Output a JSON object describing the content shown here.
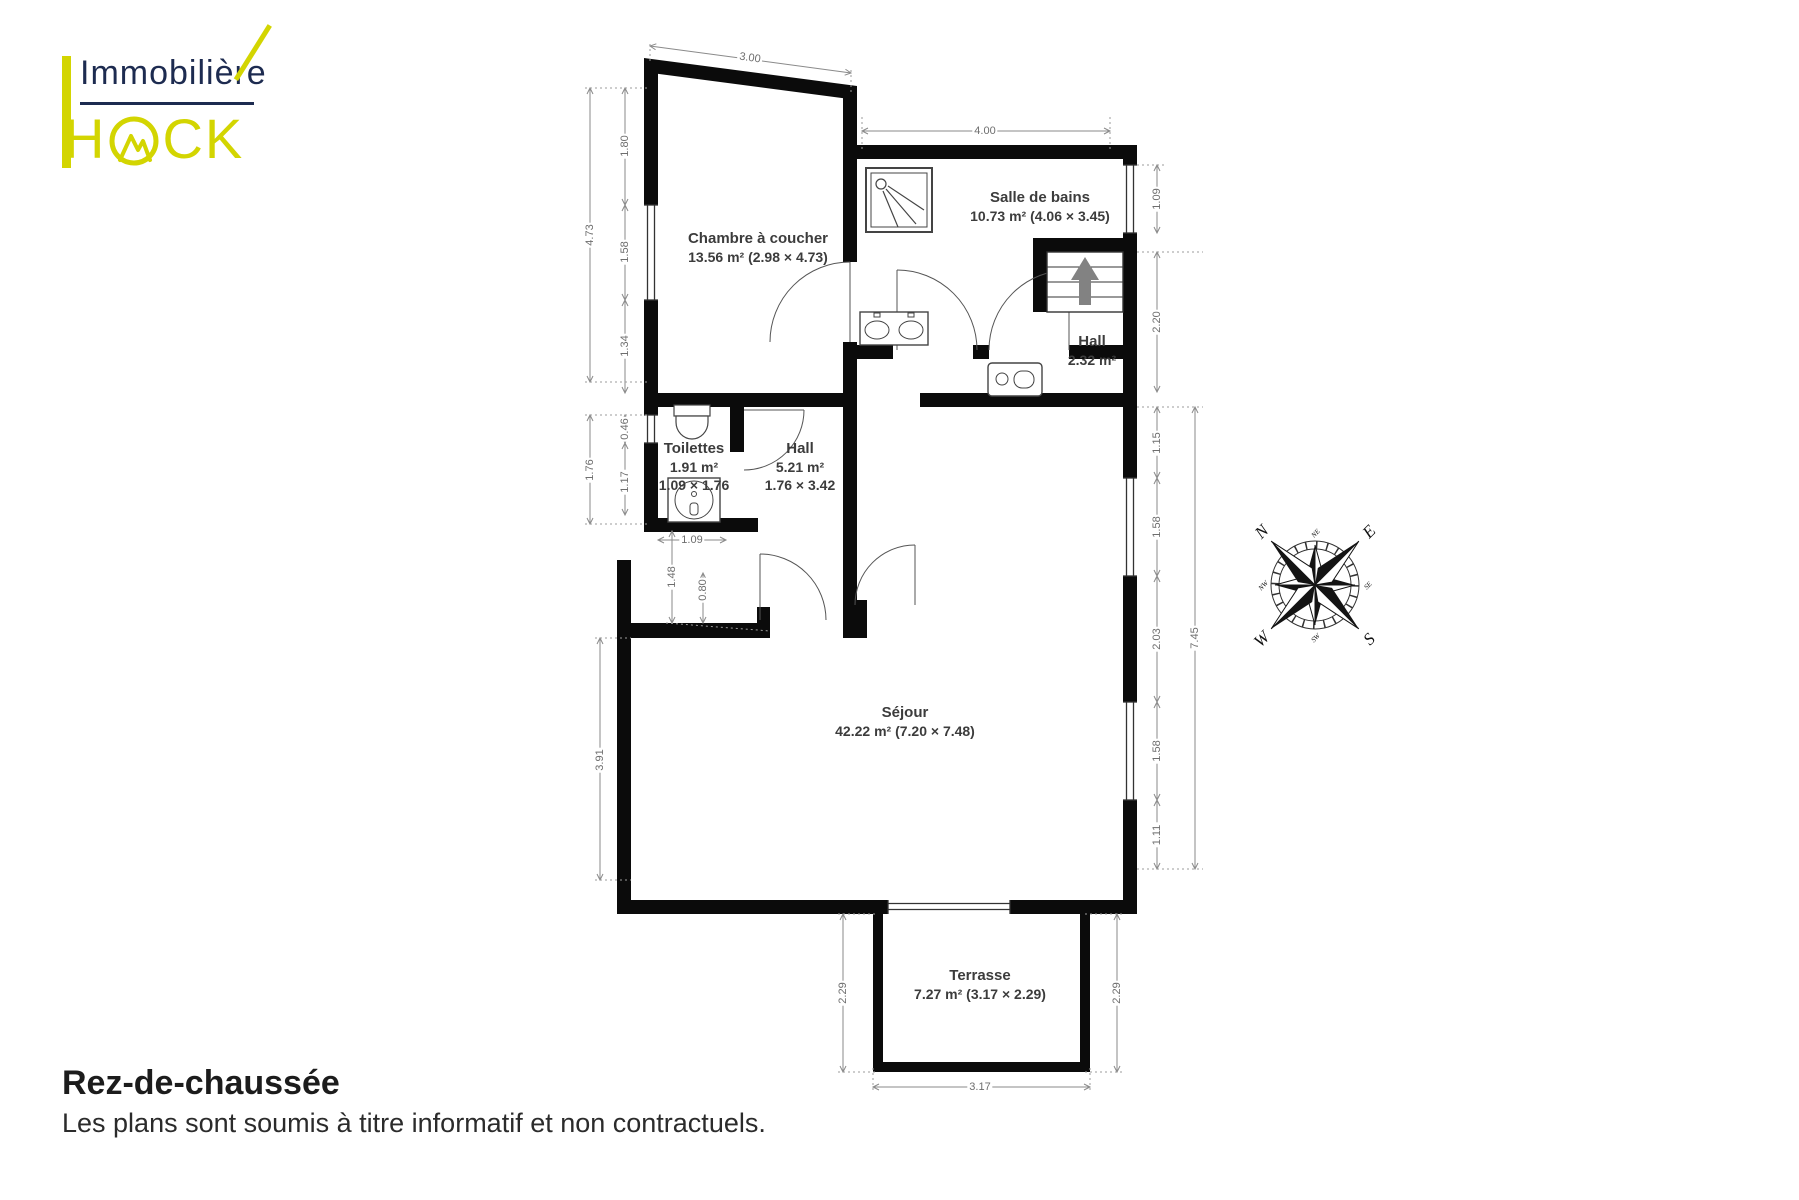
{
  "logo": {
    "name1": "Immobilière",
    "name2_full": "HACK",
    "name2_h": "H",
    "name2_ck": "CK"
  },
  "rooms": {
    "chambre": {
      "name": "Chambre à coucher",
      "area": "13.56 m² (2.98 × 4.73)"
    },
    "bains": {
      "name": "Salle de bains",
      "area": "10.73 m² (4.06 × 3.45)"
    },
    "hall_haut": {
      "name": "Hall",
      "area": "2.32 m²"
    },
    "toilettes": {
      "name": "Toilettes",
      "area": "1.91 m²",
      "dims": "1.09 × 1.76"
    },
    "hall": {
      "name": "Hall",
      "area": "5.21 m²",
      "dims": "1.76 × 3.42"
    },
    "sejour": {
      "name": "Séjour",
      "area": "42.22 m² (7.20 × 7.48)"
    },
    "terrasse": {
      "name": "Terrasse",
      "area": "7.27 m² (3.17 × 2.29)"
    }
  },
  "dims": {
    "top_bedroom": "3.00",
    "bedroom_h": "4.73",
    "seg_180": "1.80",
    "seg_158": "1.58",
    "seg_134": "1.34",
    "toilettes_h": "1.76",
    "seg_046": "0.46",
    "seg_117": "1.17",
    "toilettes_w": "1.09",
    "hall_148": "1.48",
    "hall_080": "0.80",
    "sejour_left": "3.91",
    "bath_w": "4.00",
    "bath_win": "1.09",
    "stairs_h": "2.20",
    "right_115": "1.15",
    "right_158a": "1.58",
    "right_203": "2.03",
    "right_158b": "1.58",
    "right_111": "1.11",
    "right_total": "7.45",
    "terrace_l": "2.29",
    "terrace_r": "2.29",
    "terrace_w": "3.17"
  },
  "compass": {
    "n": "N",
    "e": "E",
    "s": "S",
    "w": "W",
    "ne": "NE",
    "se": "SE",
    "sw": "SW",
    "nw": "NW"
  },
  "footer": {
    "title": "Rez-de-chaussée",
    "subtitle": "Les plans sont soumis à titre informatif et non contractuels."
  },
  "colors": {
    "brand_yellow": "#d3d501",
    "brand_navy": "#1d2b50",
    "wall": "#0b0b0b",
    "dim_gray": "#6e6e6e"
  }
}
